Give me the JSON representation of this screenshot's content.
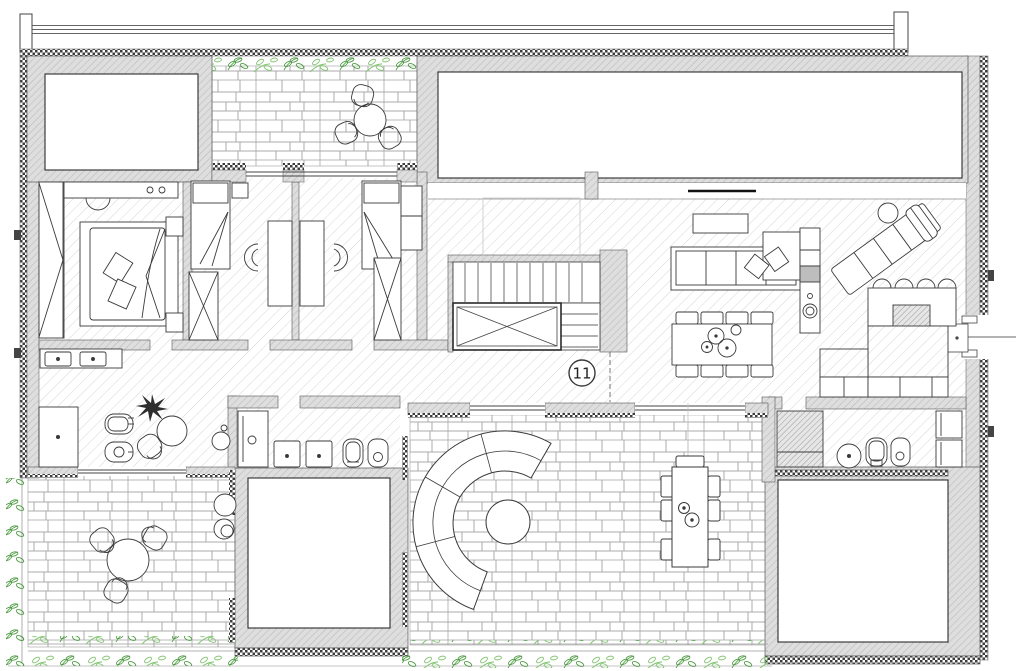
{
  "plan": {
    "unit_label": "11",
    "colors": {
      "background": "#ffffff",
      "wall_fill": "#dedede",
      "wall_hatch_line": "#b9b9b9",
      "floor_hatch_line": "#d6d6d6",
      "brick_joint": "#a8a8a8",
      "insulation_dot": "#3c3c3c",
      "foliage_dark": "#4c9b41",
      "foliage_light": "#7ec36b",
      "outline": "#333333",
      "door_swing_line": "#9a9a9a"
    }
  }
}
